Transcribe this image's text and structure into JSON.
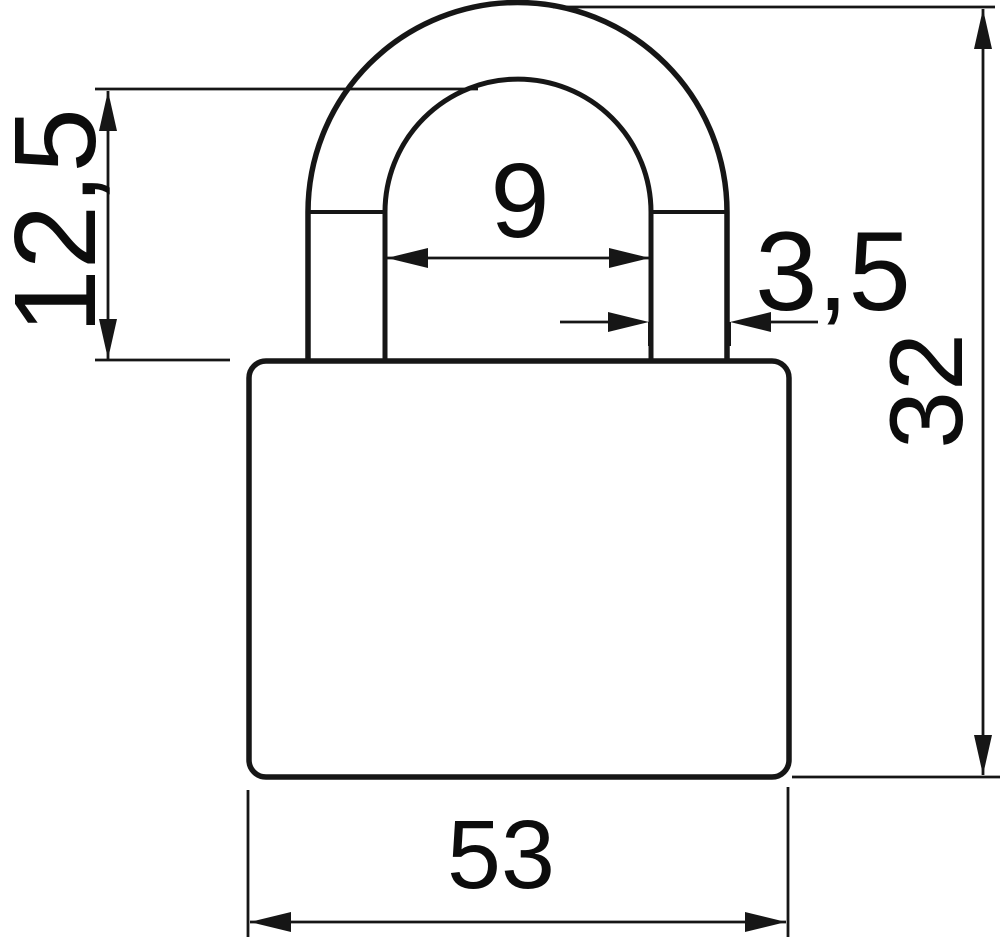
{
  "page": {
    "background": "#ffffff"
  },
  "drawing": {
    "subject": "padlock-front-view-technical-drawing",
    "line_color": "#161616",
    "dimension_labels": {
      "shackle_clearance_height": "12,5",
      "shackle_inner_width": "9",
      "shackle_wire_diameter": "3,5",
      "overall_height": "32",
      "body_width": "53"
    }
  }
}
